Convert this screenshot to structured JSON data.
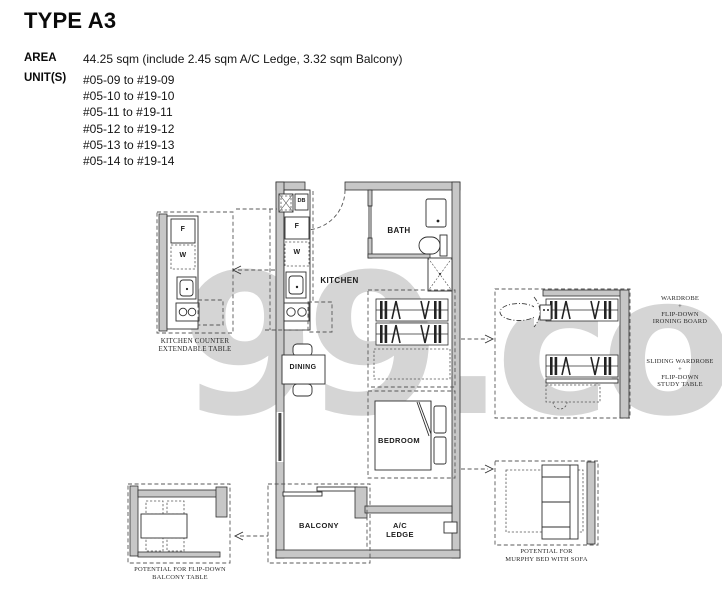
{
  "header": {
    "title": "TYPE A3",
    "area_label": "AREA",
    "area_value": "44.25 sqm (include 2.45 sqm A/C Ledge, 3.32 sqm Balcony)",
    "units_label": "UNIT(S)",
    "units": [
      "#05-09 to #19-09",
      "#05-10 to #19-10",
      "#05-11 to #19-11",
      "#05-12 to #19-12",
      "#05-13 to #19-13",
      "#05-14 to #19-14"
    ]
  },
  "plan": {
    "rooms": {
      "kitchen": "KITCHEN",
      "bath": "BATH",
      "dining": "DINING",
      "bedroom": "BEDROOM",
      "balcony": "BALCONY",
      "ac_line1": "A/C",
      "ac_line2": "LEDGE"
    },
    "fixtures": {
      "fridge": "F",
      "washer": "W",
      "db": "DB"
    },
    "insets": {
      "kitchen_counter": {
        "lines": [
          "KITCHEN COUNTER",
          "EXTENDABLE TABLE"
        ],
        "fridge": "F",
        "washer": "W"
      },
      "wardrobe_ironing": {
        "lines": [
          "WARDROBE",
          "+",
          "FLIP-DOWN",
          "IRONING BOARD"
        ]
      },
      "sliding_wardrobe": {
        "lines": [
          "SLIDING WARDROBE",
          "+",
          "FLIP-DOWN",
          "STUDY TABLE"
        ]
      },
      "murphy_bed": {
        "lines": [
          "POTENTIAL FOR",
          "MURPHY BED WITH SOFA"
        ]
      },
      "balcony_table": {
        "lines": [
          "POTENTIAL FOR FLIP-DOWN",
          "BALCONY TABLE"
        ]
      }
    }
  },
  "watermark": "99.co",
  "colors": {
    "wall_fill": "#c7c7c7",
    "line": "#2f2f2f",
    "watermark": "#d5d5d5",
    "text": "#111111"
  }
}
